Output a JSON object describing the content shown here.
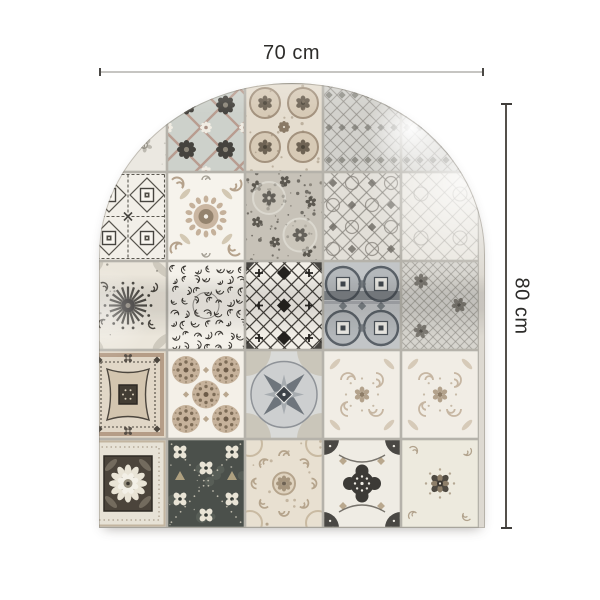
{
  "figure": {
    "kind": "product-dimension-diagram",
    "product": "arched patchwork tile panel"
  },
  "dimensions": {
    "width_label": "70 cm",
    "height_label": "80 cm"
  },
  "annotation": {
    "line_color_light": "#c6c5c2",
    "line_color_dark": "#4a4845",
    "text_color": "#2d2c2a",
    "background": "#ffffff"
  },
  "panel": {
    "shape": "arch",
    "grout_color": "#b5b2aa",
    "grid": {
      "cols": 6,
      "rows": 5,
      "tile_w": 78,
      "tile_h": 89,
      "offset_x": -44
    },
    "palette": {
      "white": "#f4f1ea",
      "offwhite": "#eae6dd",
      "beige": "#c3ae97",
      "taupe": "#a08f7b",
      "gray": "#8f8c85",
      "slate": "#565c61",
      "charcoal": "#3c3a36",
      "darkgreen": "#4b504b"
    },
    "tile_patterns": [
      [
        "faded",
        "fadedFloral",
        "diamondFlowers",
        "taupeFloral",
        "grayLattice",
        "grayLattice"
      ],
      [
        "fadedFloral",
        "squaresCross",
        "scrollMedallion",
        "floralCircles",
        "arabesque",
        "arabesqueLight"
      ],
      [
        "arabesque",
        "sunflower",
        "laceScroll",
        "crosshatch",
        "circleSquares",
        "grayOrnate"
      ],
      [
        "toile",
        "concentricFrames",
        "dotCircles",
        "compass",
        "swirlLight",
        "swirlLight"
      ],
      [
        "taupeChevron",
        "flowerFrame",
        "darkPetals",
        "softDamask",
        "quatrefoil",
        "lightCross"
      ]
    ]
  }
}
